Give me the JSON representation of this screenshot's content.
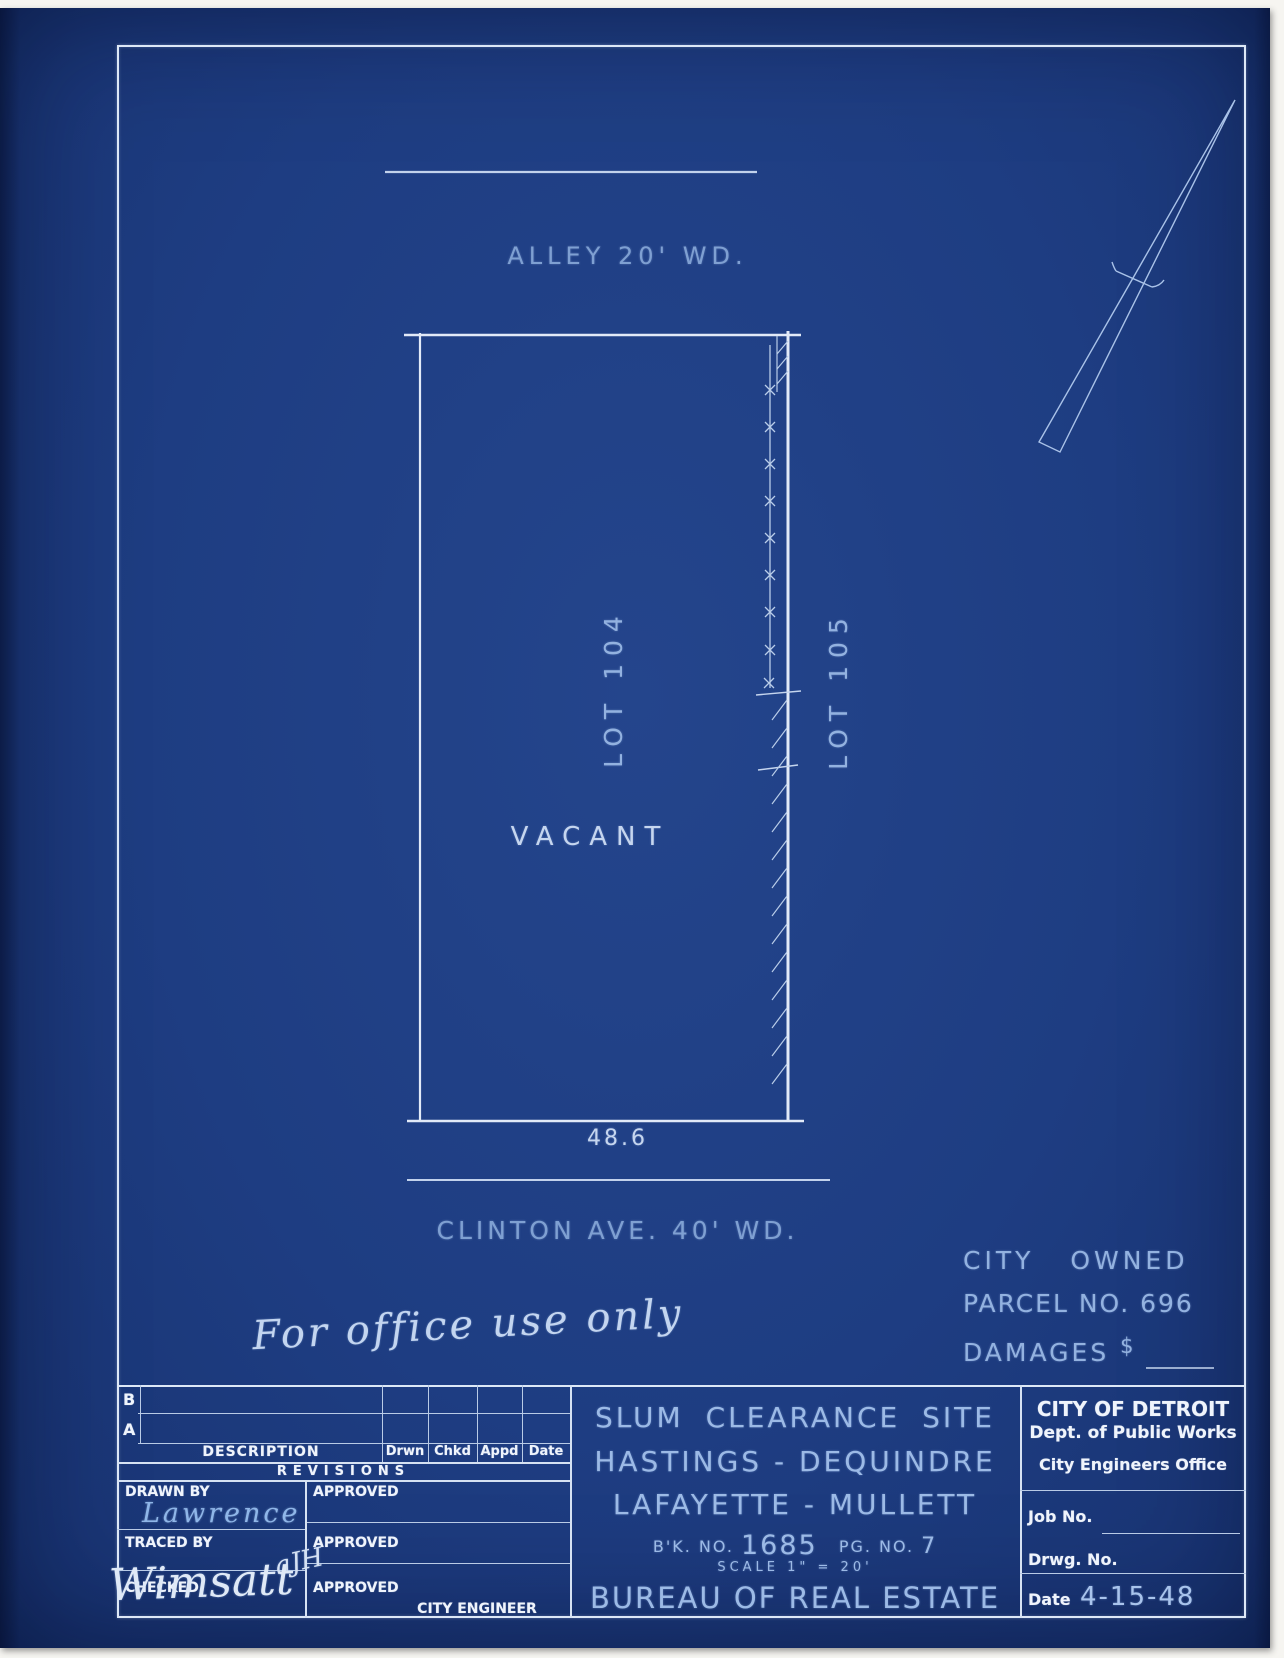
{
  "drawing": {
    "alley_label": "ALLEY 20' WD.",
    "lot_104_label": "LOT 104",
    "lot_105_label": "LOT 105",
    "vacant_label": "VACANT",
    "frontage_dimension": "48.6",
    "street_label": "CLINTON AVE. 40' WD.",
    "ownership_note": {
      "line1": "CITY OWNED",
      "line2": "PARCEL NO. 696",
      "damages_label": "DAMAGES",
      "damages_symbol": "$"
    },
    "office_note": "For office use only"
  },
  "title_block": {
    "revisions": {
      "row_b": "B",
      "row_a": "A",
      "description_header": "DESCRIPTION",
      "drwn_header": "Drwn",
      "chkd_header": "Chkd",
      "appd_header": "Appd",
      "date_header": "Date",
      "caption": "REVISIONS"
    },
    "signoff": {
      "drawn_by_label": "DRAWN BY",
      "drawn_by_value": "Lawrence",
      "traced_by_label": "TRACED BY",
      "checked_label": "CHECKED",
      "checked_initials": "aJH",
      "checked_signature": "Wimsatt",
      "approved_label_1": "APPROVED",
      "approved_label_2": "APPROVED",
      "approved_label_3": "APPROVED",
      "city_engineer_label": "CITY ENGINEER"
    },
    "project": {
      "title_line1": "SLUM CLEARANCE SITE",
      "title_line2": "HASTINGS - DEQUINDRE",
      "title_line3": "LAFAYETTE - MULLETT",
      "book_label": "B'K. NO.",
      "book_value": "1685",
      "page_label": "PG. NO.",
      "page_value": "7",
      "scale_label": "SCALE",
      "scale_value": "1\" = 20'",
      "bureau_line": "BUREAU OF REAL ESTATE"
    },
    "agency": {
      "city": "CITY OF DETROIT",
      "department": "Dept. of Public Works",
      "office": "City Engineers Office",
      "job_no_label": "Job No.",
      "drwg_no_label": "Drwg. No.",
      "date_label": "Date",
      "date_value": "4-15-48"
    }
  },
  "colors": {
    "paper": "#1e3d82",
    "line_strong": "#e6edf9",
    "line_medium": "#c2d2ec",
    "hand_text": "#9fbbe6",
    "hand_text_faint": "#7fa0d2",
    "printed_text": "#eff4fc"
  }
}
